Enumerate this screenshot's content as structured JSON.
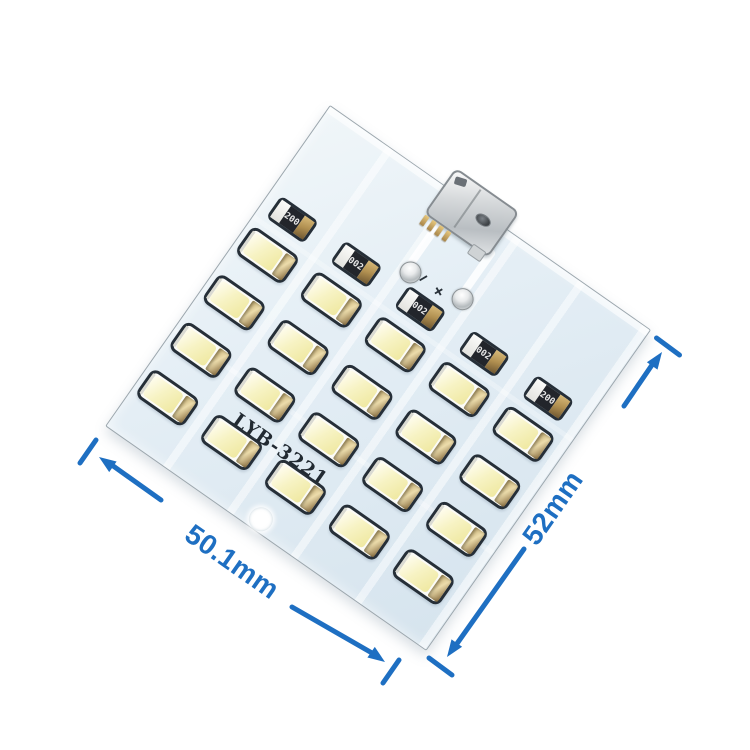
{
  "pcb": {
    "silkscreen_text": "LYB-3221",
    "led_count": 20,
    "board_color": "#dfeaf2",
    "silkscreen_color": "#232b33",
    "resistors": [
      {
        "label": "200"
      },
      {
        "label": "002"
      },
      {
        "label": "002"
      },
      {
        "label": "002"
      },
      {
        "label": "200"
      }
    ],
    "polarity_minus": "−",
    "polarity_plus": "+"
  },
  "dims": {
    "width_label": "50.1mm",
    "height_label": "52mm",
    "color": "#1e6fc2"
  }
}
